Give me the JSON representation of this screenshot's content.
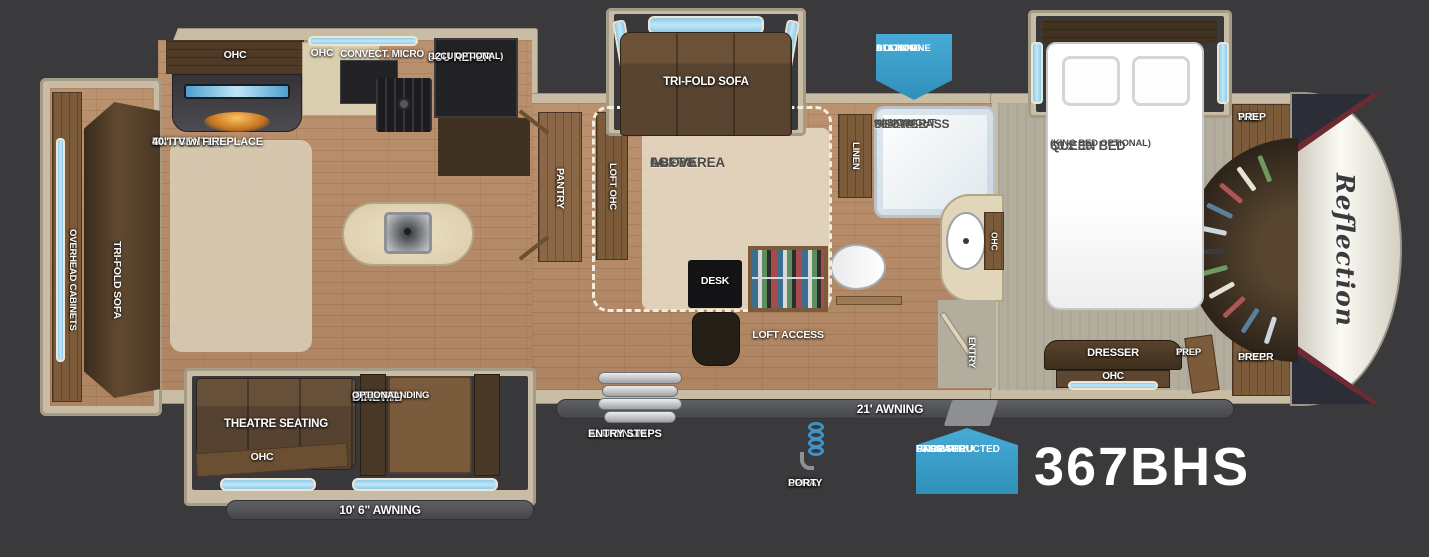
{
  "model_number": "367BHS",
  "brand": "Reflection",
  "colors": {
    "background": "#3a3a3c",
    "badge_blue": "#3ba1cd",
    "wall_beige": "#c8bda4",
    "wood_floor": "#b78b67",
    "bedroom_floor": "#b2ad9c",
    "dark_wood": "#5c4731",
    "window_blue": "#a9d9f0"
  },
  "badges": {
    "docking": {
      "lines": [
        "ALL-IN-ONE",
        "DOCKING",
        "STATION"
      ]
    },
    "pass_thru": {
      "lines": [
        "UNOBSTRUCTED",
        "PASS-THRU",
        "STORAGE"
      ]
    }
  },
  "exterior": {
    "awning_main": "21' AWNING",
    "awning_small": "10' 6\" AWNING",
    "steps": {
      "lines": [
        "ALUMINUM",
        "ENTRY STEPS"
      ]
    },
    "spray_port": {
      "lines": [
        "SPRAY",
        "PORT"
      ]
    }
  },
  "living": {
    "overhead_cabinets": "OVERHEAD CABINETS",
    "rear_sofa": "TRI-FOLD SOFA",
    "ent_center": {
      "lines": [
        "ENT. CENTER",
        "40\" TV w/ FIREPLACE"
      ]
    },
    "ohc": "OHC",
    "theatre": "THEATRE SEATING",
    "theatre_ohc": "OHC",
    "dinette": {
      "lines": [
        "BOOTH",
        "DINETTE",
        "(FREE STANDING",
        "OPTIONAL)"
      ]
    }
  },
  "kitchen": {
    "ohc": "OHC",
    "micro": "CONVECT. MICRO",
    "refer": {
      "lines": [
        "8CU REFER",
        "(12CU OPTIONAL)"
      ]
    },
    "pantry": "PANTRY"
  },
  "loft": {
    "ohc": "LOFT OHC",
    "area": {
      "lines": [
        "64 x 88",
        "LOFT AREA",
        "ABOVE"
      ]
    },
    "sofa": "TRI-FOLD SOFA",
    "desk": "DESK",
    "access": "LOFT ACCESS"
  },
  "bath": {
    "linen": "LINEN",
    "shower": {
      "lines": [
        "30 x 48",
        "FIBERGLASS",
        "SHOWER",
        "w/ SKYLIGHT"
      ]
    },
    "ohc": "OHC",
    "entry": "ENTRY"
  },
  "bedroom": {
    "bed": {
      "lines": [
        "60 x 80",
        "QUEEN BED",
        "(KING BED OPTIONAL)"
      ]
    },
    "dresser": "DRESSER",
    "ohc": "OHC",
    "tv_prep": {
      "lines": [
        "TV",
        "PREP"
      ]
    },
    "wd_prep": {
      "lines": [
        "W/D",
        "PREP"
      ]
    },
    "dryer_prep": {
      "lines": [
        "DRYER",
        "PREP"
      ]
    }
  }
}
